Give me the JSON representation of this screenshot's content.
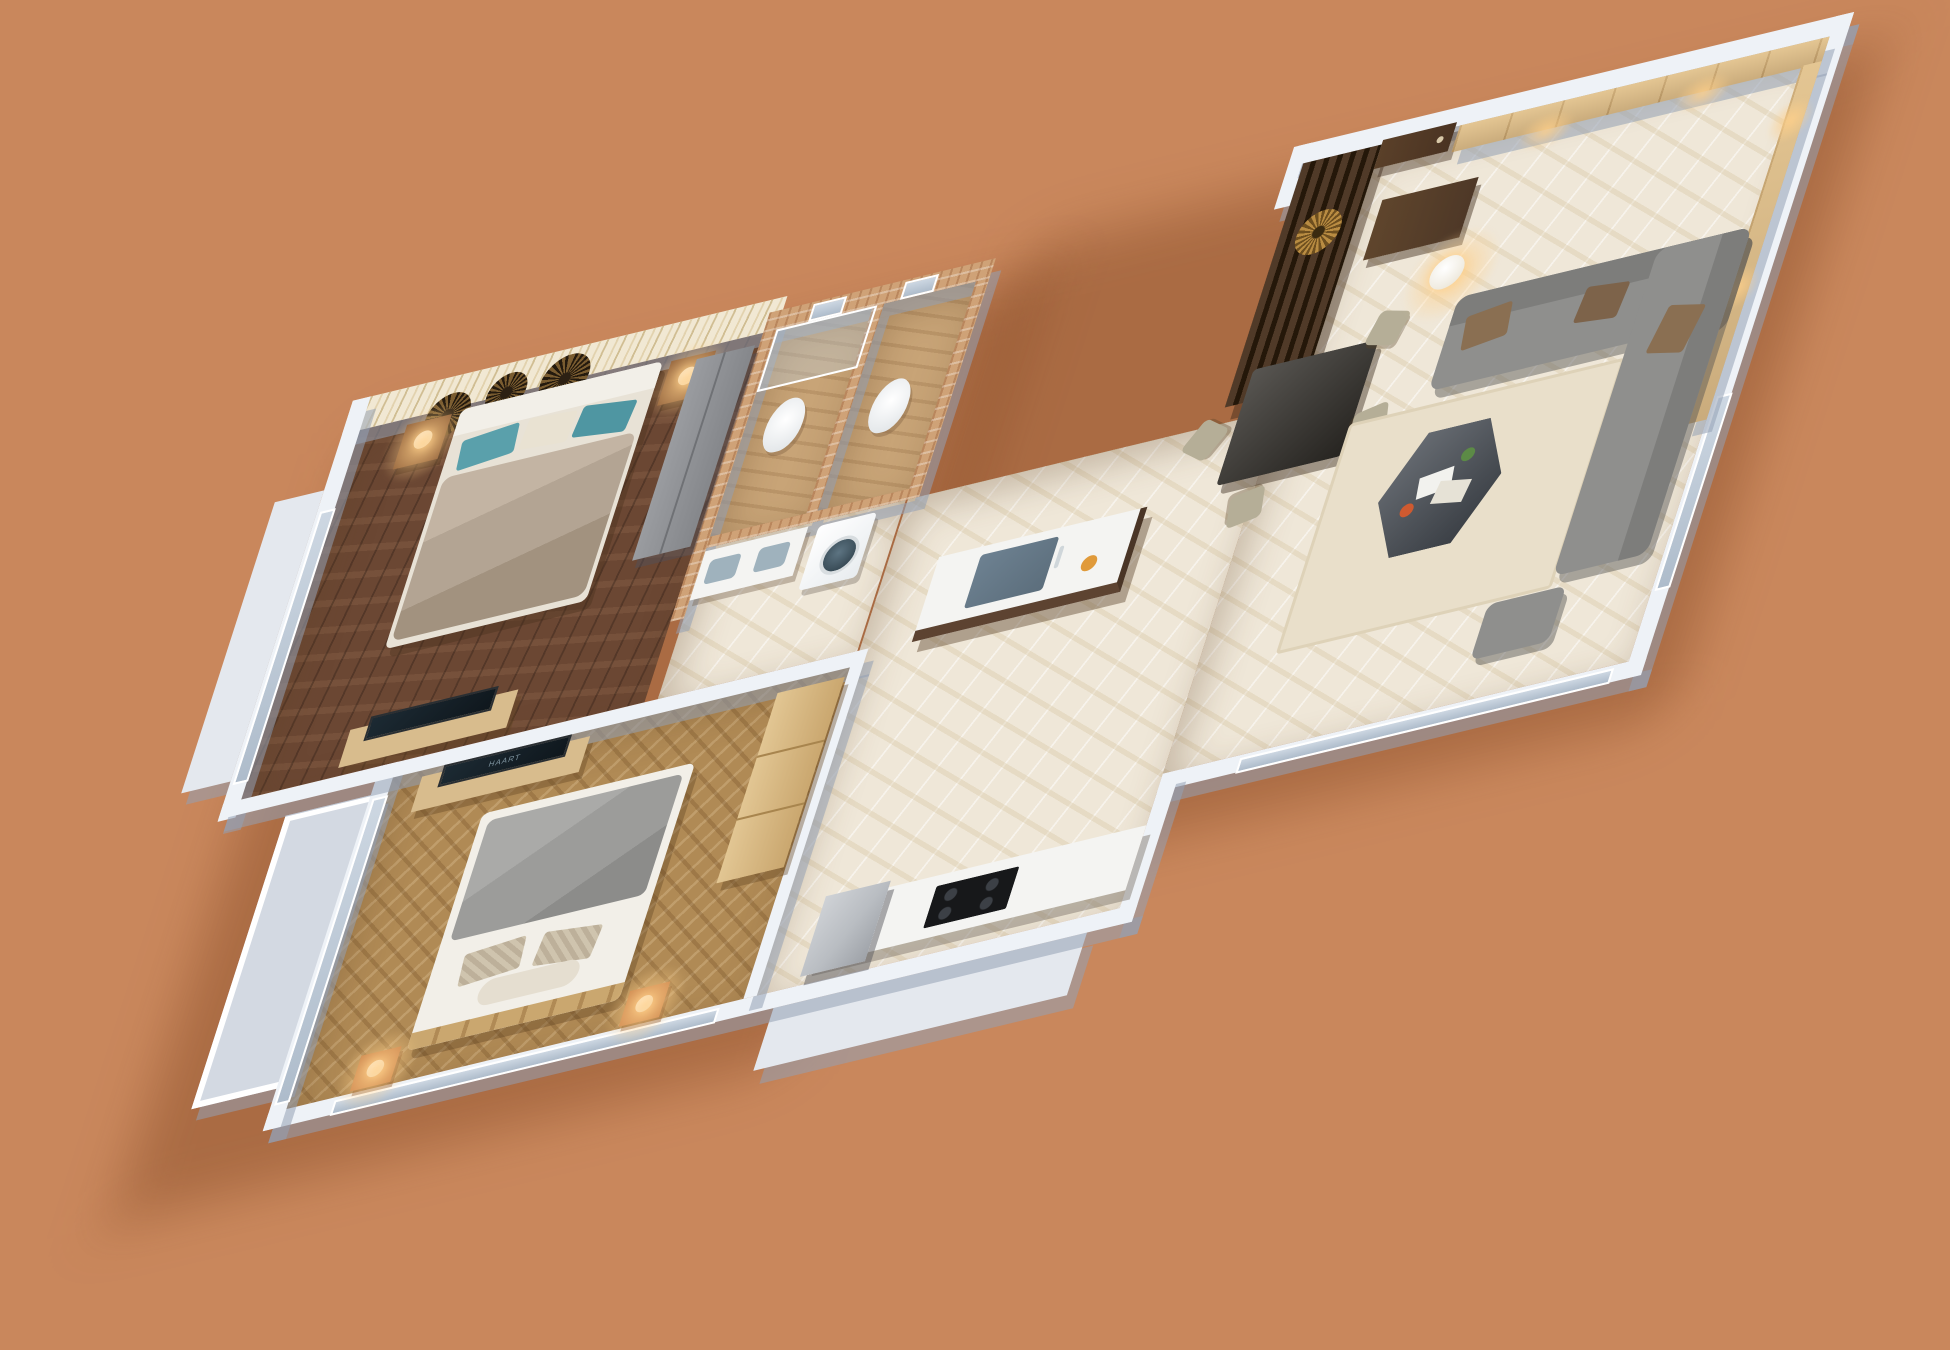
{
  "scene": {
    "type": "isometric-3d-floor-plan",
    "description": "3D rendered floor plan of a two-bedroom apartment viewed from above on a terracotta background",
    "tv_logo": "HAART"
  },
  "palette": {
    "bg": "#c9875c",
    "wall": "#eef2f7",
    "wall_shadow": "rgba(148,160,180,0.55)",
    "floor_master": "#6b4733",
    "floor_bedroom2": "#b08a55",
    "floor_marble": "#efe7d8",
    "floor_bath": "#c8a477",
    "wallpaper": "#f1e8d3",
    "brick": "#cfa277",
    "wood_light": "#d8bc8d",
    "wood_mid": "#caa76f",
    "wood_dark": "#4e3827",
    "sofa": "#8f8f8d",
    "sofa_dark": "#7d7d7b",
    "cushion": "#8a6f52",
    "bed_master": "#b3a493",
    "teal": "#5aa0ab",
    "blanket": "#9c9c9a",
    "linen": "#f2efe8",
    "tv_dark": "#0f171d",
    "steel": "#b9bdc2",
    "counter_base": "#5d4331",
    "counter_top": "#f4f4f2",
    "sink": "#5c6e7c",
    "nightstand": "#c88049",
    "rug": "#e9dfca",
    "table_dark": "#33302b",
    "chair": "#b5ae97",
    "gold": "#b98c42",
    "door": "#4a3322",
    "hob": "#17181a",
    "ledge": "#e4e8ee",
    "shadow": "rgba(112,54,20,0.35)"
  },
  "rooms": [
    {
      "name": "master bedroom"
    },
    {
      "name": "bathroom"
    },
    {
      "name": "toilet"
    },
    {
      "name": "corridor"
    },
    {
      "name": "second bedroom"
    },
    {
      "name": "kitchen"
    },
    {
      "name": "living and dining room"
    },
    {
      "name": "balcony"
    }
  ]
}
